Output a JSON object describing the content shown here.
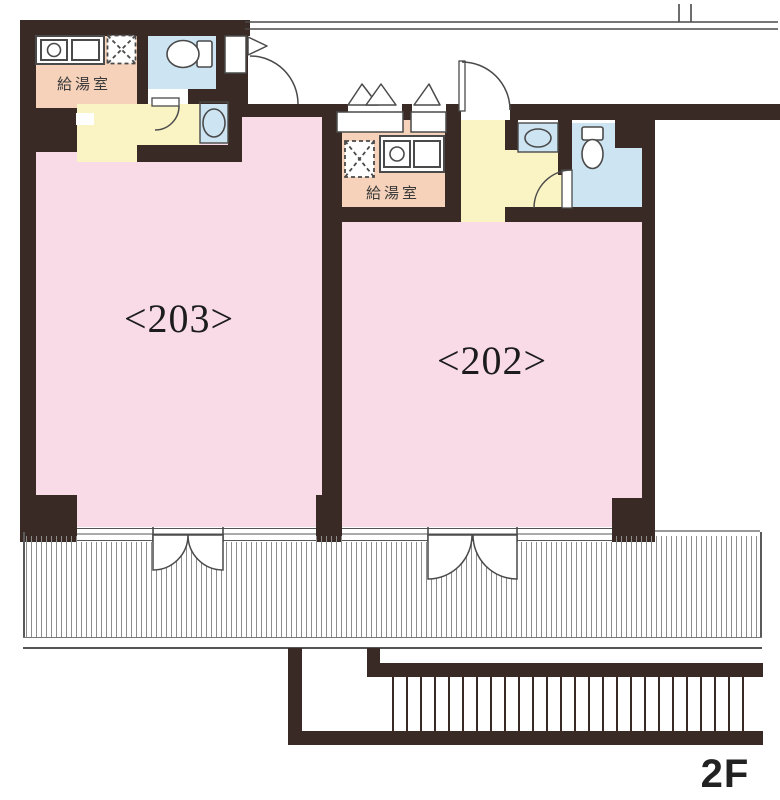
{
  "floorplan": {
    "floor_label": "2F",
    "units": [
      {
        "number": "203",
        "room_label": "<203>",
        "kitchenette_label": "給湯室"
      },
      {
        "number": "202",
        "room_label": "<202>",
        "kitchenette_label": "給湯室"
      }
    ],
    "areas": {
      "balcony": "hatched balcony strip",
      "staircase": "external stairs bottom right",
      "corridor": "open corridor along top"
    },
    "icons": {
      "toilet": "toilet-icon",
      "washbasin": "washbasin-icon",
      "kitchen_counter": "kitchen-counter-icon",
      "refrigerator_space": "hatched-box-icon",
      "door_swing": "door-arc-icon",
      "casement_window": "window-triangle-icon",
      "french_door": "double-door-arc-icon"
    },
    "colors": {
      "wall": "#3a2a25",
      "room_pink": "#f8dbe7",
      "kitchenette_salmon": "#f6d2ba",
      "hall_yellow": "#faf4c4",
      "sanitary_blue": "#cde4f2",
      "thin_line": "#4a4a4a"
    }
  }
}
